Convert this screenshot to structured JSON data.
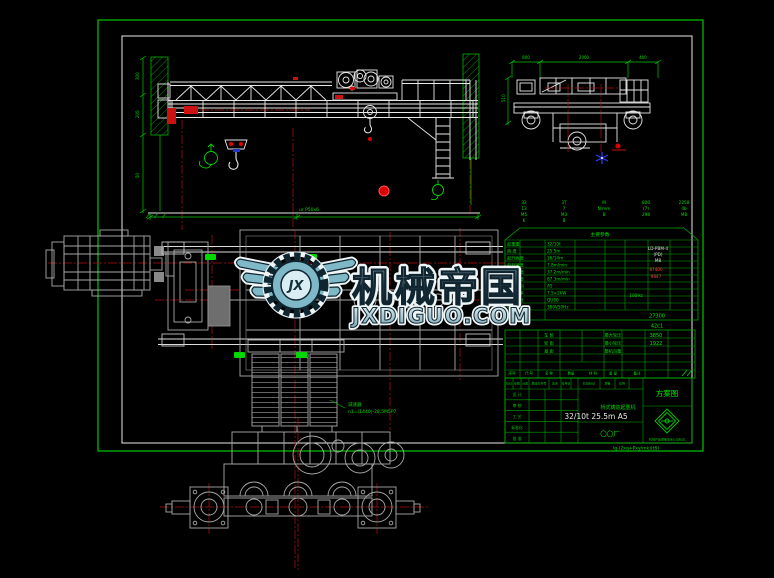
{
  "watermark": {
    "initials": "JX",
    "brand": "机械帝国",
    "site": "JXDIGUO.COM"
  },
  "elevation_view": {
    "dim_labels": [
      "300",
      "205",
      "50"
    ],
    "rail_note": "ur P50x6"
  },
  "end_view": {
    "dims_top": [
      "800",
      "2000",
      "400"
    ],
    "dim_left": "510"
  },
  "plan_view": {
    "note_line1": "减速器",
    "note_line2": "n1=(1440)-28.5M5P7"
  },
  "param_table": {
    "title": "主要参数",
    "header_columns": [
      [
        "32",
        "13",
        "M5",
        "K"
      ],
      [
        "3T",
        "7",
        "M3",
        "B"
      ],
      [
        "M",
        "N/mm",
        "B"
      ],
      [
        "800",
        "(7)",
        "298"
      ],
      [
        "2258",
        "4b",
        "M8"
      ]
    ],
    "rows_left": [
      "起重量",
      "跨 度",
      "起升高度",
      "起升速度",
      "小车速度",
      "大车速度",
      "工作级别",
      "电机功率",
      "轨道型号",
      "电 源"
    ],
    "rows_mid": [
      "32/10t",
      "25.5m",
      "16/14m",
      "7.8m/min",
      "37.2m/min",
      "87.3m/min",
      "A5",
      "7.5×2kW",
      "QU80",
      "380V50Hz"
    ],
    "value_white": [
      "LD-PBM-4",
      "(PD)",
      "M8"
    ],
    "values_red": [
      "87400",
      "9847"
    ],
    "value_hz": "100Hz",
    "bottom_value": "27300",
    "table_tag": "42c1"
  },
  "bom_table": {
    "rows": [
      {
        "c1": "车 轮",
        "c2": "最大轮压",
        "value": "3850"
      },
      {
        "c1": "轮 距",
        "c2": "最小轮压",
        "value": "1922"
      },
      {
        "c1": "基 距",
        "c2": "整机自重",
        "value": ""
      }
    ],
    "header": [
      "序号",
      "代 号",
      "名 称",
      "数量",
      "材 料",
      "重 量",
      "备注"
    ]
  },
  "title_block": {
    "rev_header": [
      "标记",
      "处数",
      "分区",
      "更改文件号",
      "签名",
      "年月日"
    ],
    "stage_header": [
      "阶段标记",
      "质量",
      "比例"
    ],
    "sign_labels": [
      "设 计",
      "审 核",
      "工 艺",
      "标准化",
      "批 准"
    ],
    "scheme_label": "方案图",
    "product_title": "桥式铸造起重机",
    "spec": "32/10t 25.5m A5",
    "company": "〇〇厂",
    "cert_note": "机械产品质量体系认证标志",
    "drawing_no": "lq-(2xq+Pxy/mk)(t6)"
  }
}
